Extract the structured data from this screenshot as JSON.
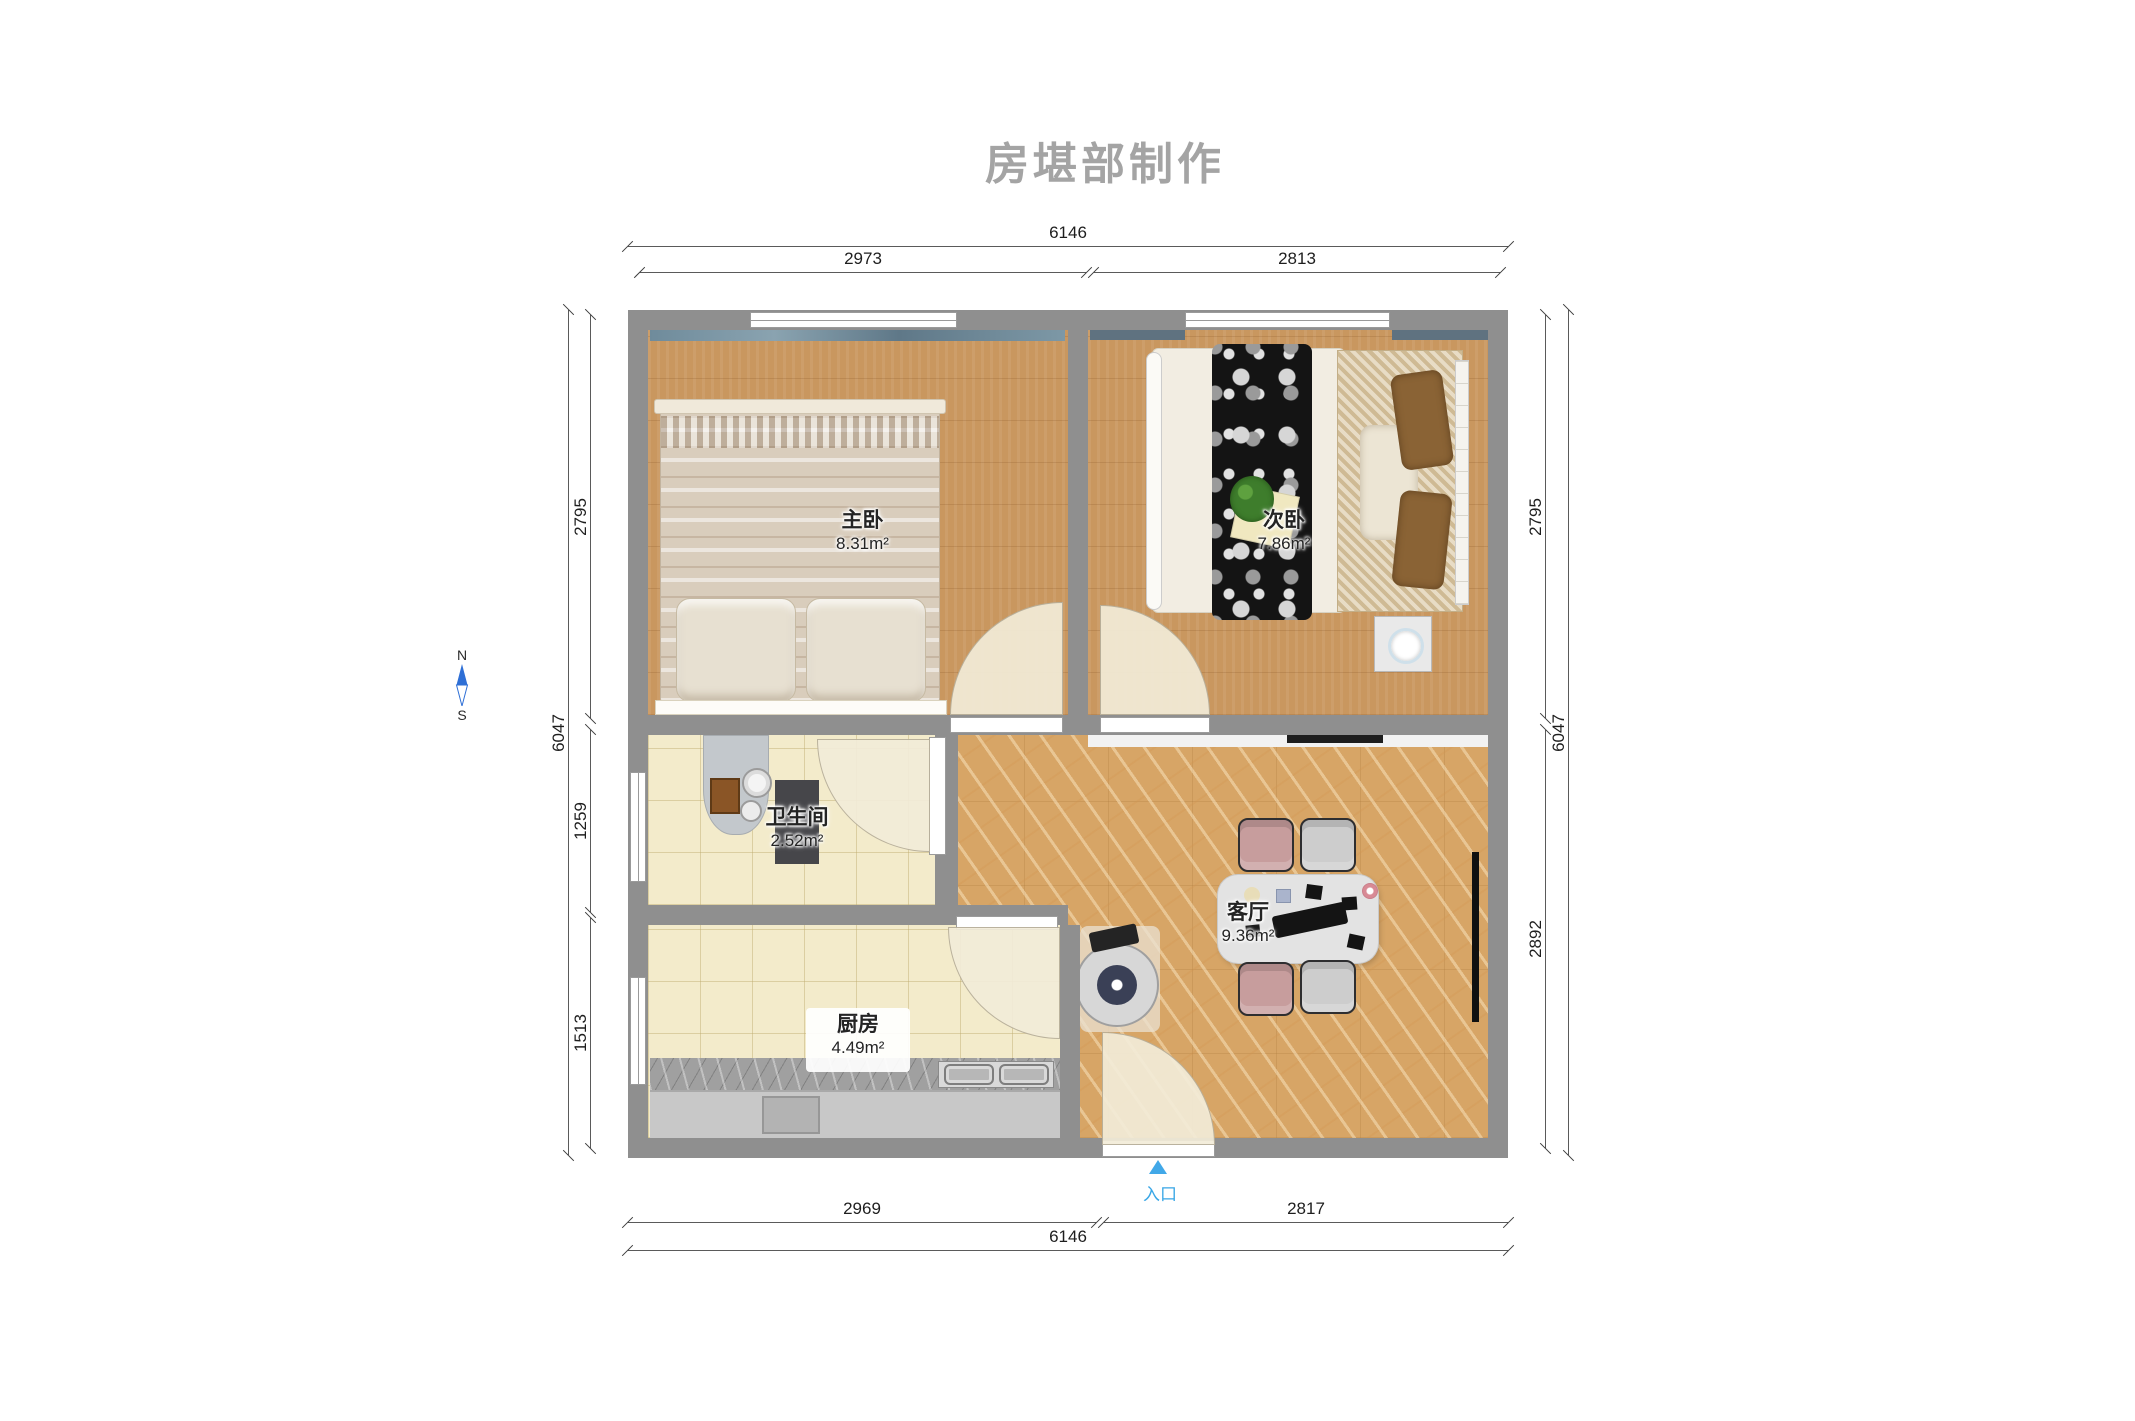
{
  "title": "房堪部制作",
  "compass": {
    "north_label": "N",
    "south_label": "S"
  },
  "entrance": {
    "label": "入口"
  },
  "rooms": {
    "master_bedroom": {
      "name": "主卧",
      "area": "8.31m²"
    },
    "second_bedroom": {
      "name": "次卧",
      "area": "7.86m²"
    },
    "bathroom": {
      "name": "卫生间",
      "area": "2.52m²"
    },
    "kitchen": {
      "name": "厨房",
      "area": "4.49m²"
    },
    "living_room": {
      "name": "客厅",
      "area": "9.36m²"
    }
  },
  "dimensions": {
    "top": {
      "overall": "6146",
      "left_segment": "2973",
      "right_segment": "2813"
    },
    "bottom": {
      "overall": "6146",
      "left_segment": "2969",
      "right_segment": "2817"
    },
    "left": {
      "overall": "6047",
      "segments": [
        "2795",
        "1259",
        "1513"
      ]
    },
    "right": {
      "overall": "6047",
      "segments": [
        "2795",
        "2892"
      ]
    }
  },
  "colors": {
    "wall": "#8f8f8f",
    "wood_floor": "#c9975f",
    "tile_floor": "#f3ebcb",
    "marble_floor": "#d7a566",
    "entrance_accent": "#41a8e8",
    "compass_blue": "#2e6fd6",
    "title_gray": "#a4a4a4"
  }
}
